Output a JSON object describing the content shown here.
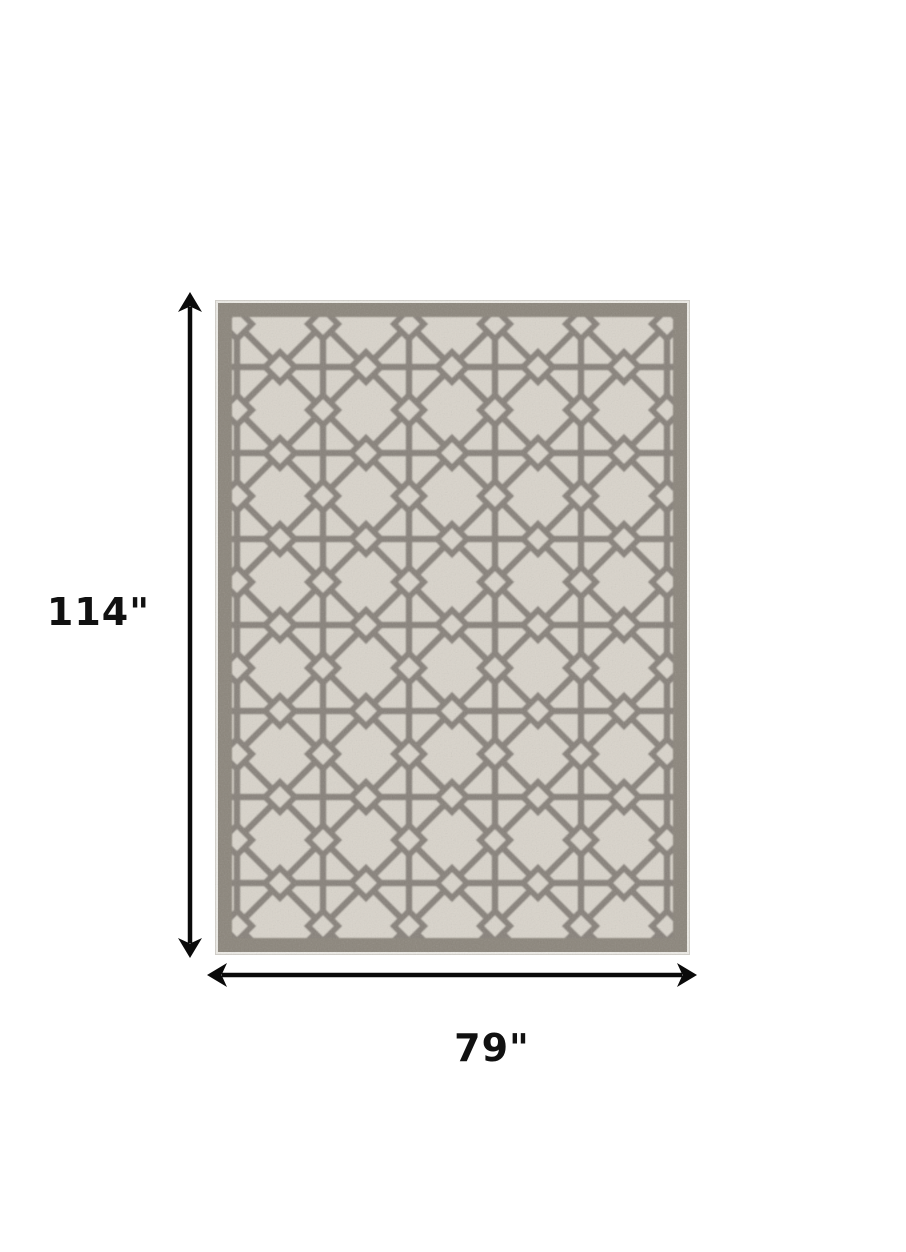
{
  "diagram_type": "product dimension diagram",
  "subject": "gray and ivory geometric trellis area rug, top view",
  "annotations": {
    "height_label": "114\"",
    "width_label": "79\"",
    "arrow_color": "#0a0a0a",
    "label_color": "#111111"
  },
  "rug": {
    "pattern": "octagon and diamond lattice trellis",
    "colors": {
      "edge": "#edebe6",
      "band": "#8b857b",
      "field": "#d9d4cb",
      "line": "#87817a"
    }
  },
  "page": {
    "background": "#ffffff"
  }
}
